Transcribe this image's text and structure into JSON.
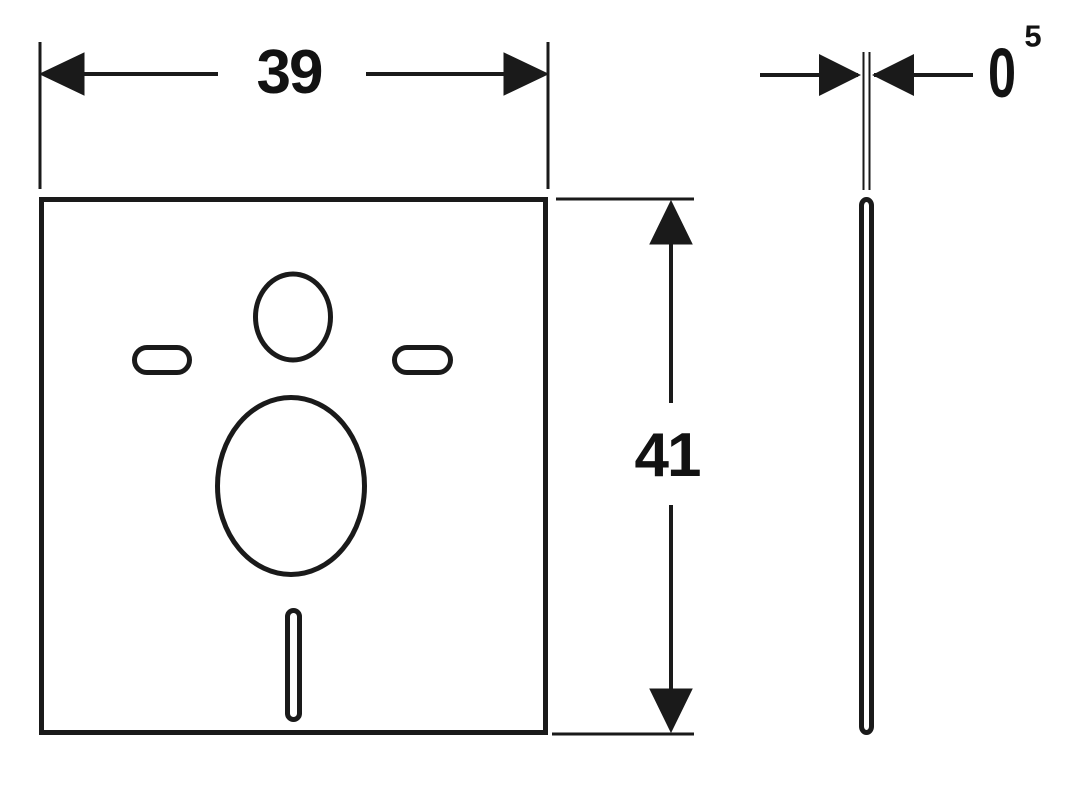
{
  "drawing": {
    "kind": "technical-dimension-drawing",
    "background_color": "#ffffff",
    "line_color": "#1a1a1a"
  },
  "dimensions": {
    "width": {
      "label": "39"
    },
    "height": {
      "label": "41"
    },
    "thickness": {
      "base": "0",
      "superscript": "5"
    }
  },
  "views": {
    "front": {
      "name": "front-view-plate",
      "cutouts": [
        "top-oval-cutout",
        "left-pill-cutout",
        "right-pill-cutout",
        "center-circle-cutout",
        "bottom-slot-cutout"
      ]
    },
    "side": {
      "name": "side-view-plate"
    }
  }
}
